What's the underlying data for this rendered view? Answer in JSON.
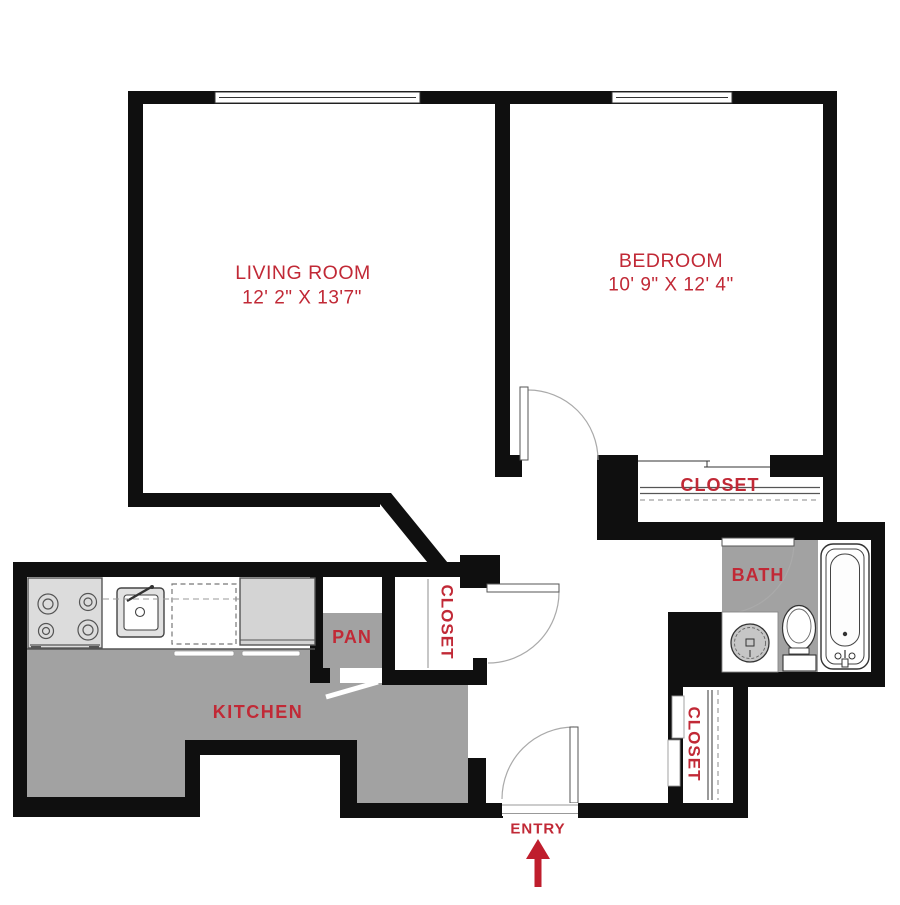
{
  "title": "One-bedroom apartment floor plan",
  "colors": {
    "wall": "#0f0f0f",
    "label": "#c12936",
    "arrow": "#bf1e2d",
    "floor_gray": "#a2a2a2",
    "appliance_gray": "#dcdcdc",
    "fridge_gray": "#d4d4d4"
  },
  "rooms": {
    "living_room": {
      "name": "LIVING ROOM",
      "dimensions": "12' 2\" X 13'7\""
    },
    "bedroom": {
      "name": "BEDROOM",
      "dimensions": "10' 9\" X 12' 4\""
    },
    "bedroom_closet": {
      "label": "CLOSET"
    },
    "bath": {
      "label": "BATH"
    },
    "pantry": {
      "label": "PAN"
    },
    "hall_closet": {
      "label": "CLOSET"
    },
    "entry_closet": {
      "label": "CLOSET"
    },
    "kitchen": {
      "label": "KITCHEN"
    },
    "entry": {
      "label": "ENTRY"
    }
  }
}
